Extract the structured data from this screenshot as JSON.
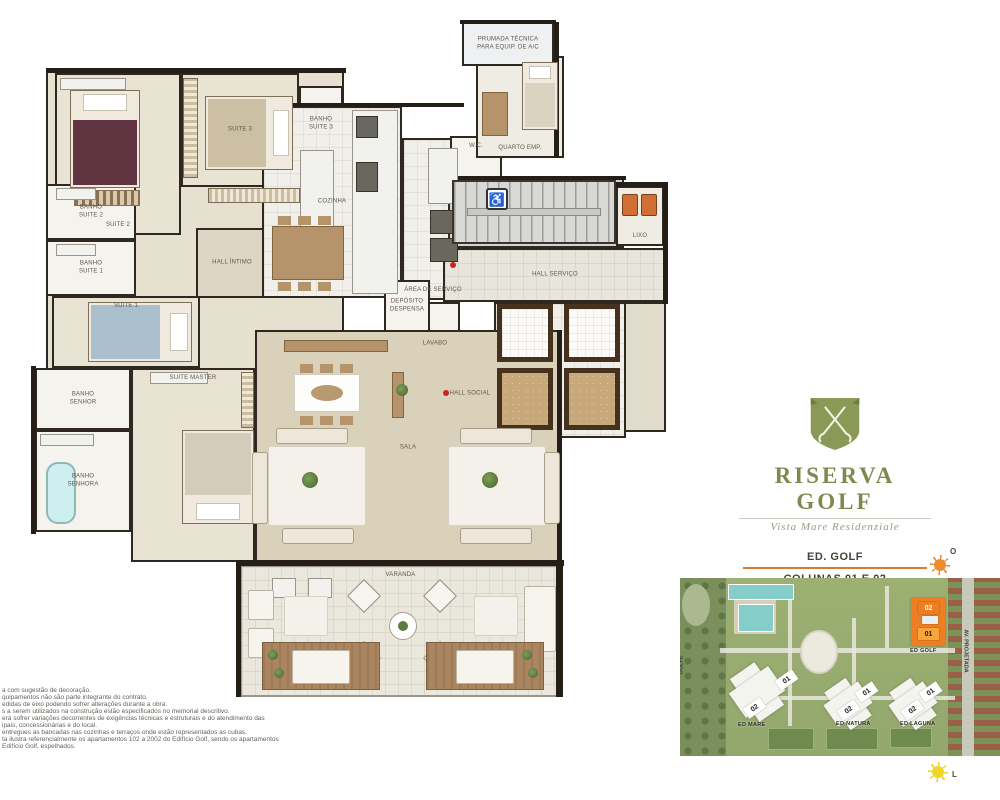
{
  "brand": {
    "name": "RISERVA GOLF",
    "tagline": "Vista Mare Residenziale"
  },
  "info": {
    "building": "ED. GOLF",
    "columns": "COLUNAS 01 E 02",
    "area": "Área Privativa - 381,06 m²"
  },
  "compass": {
    "west": "O",
    "east": "L"
  },
  "fine_print": {
    "lines": [
      "a com sugestão de decoração.",
      "quipamentos não são parte integrante do contrato.",
      "edidas de eixo podendo sofrer alterações durante a obra.",
      "s a serem utilizados na construção estão especificados no memorial descritivo.",
      "erá sofrer variações decorrentes de exigências técnicas e estruturais e do atendimento das",
      "ipais, concessionárias e do local.",
      "entregues as bancadas nas cozinhas e terraços onde estão representados as cubas.",
      "ta ilustra referencialmente os apartamentos 102 a 2002 do Edifício Golf, sendo os apartamentos",
      "Edifício Golf, espelhados."
    ]
  },
  "site_map": {
    "left_street": "GOLFE",
    "right_street": "AV. PROJETADA",
    "buildings": [
      {
        "id": "ed-mare",
        "name": "ED MARE",
        "lx": 58,
        "ly": 144,
        "bx": 62,
        "by": 88,
        "bw": 30,
        "bh": 52,
        "br": -35,
        "hl": false,
        "units": [
          {
            "t": "01",
            "x": 96,
            "y": 96,
            "r": -35,
            "s": "w"
          },
          {
            "t": "02",
            "x": 64,
            "y": 124,
            "r": -35,
            "s": "w"
          }
        ]
      },
      {
        "id": "ed-natura",
        "name": "ED NATURA",
        "lx": 156,
        "ly": 143,
        "bx": 155,
        "by": 103,
        "bw": 26,
        "bh": 46,
        "br": -35,
        "hl": false,
        "units": [
          {
            "t": "01",
            "x": 176,
            "y": 108,
            "r": -35,
            "s": "w"
          },
          {
            "t": "02",
            "x": 158,
            "y": 126,
            "r": -35,
            "s": "w"
          }
        ]
      },
      {
        "id": "ed-laguna",
        "name": "ED LAGUNA",
        "lx": 220,
        "ly": 143,
        "bx": 220,
        "by": 103,
        "bw": 26,
        "bh": 46,
        "br": -35,
        "hl": false,
        "units": [
          {
            "t": "01",
            "x": 240,
            "y": 108,
            "r": -35,
            "s": "w"
          },
          {
            "t": "02",
            "x": 222,
            "y": 126,
            "r": -35,
            "s": "w"
          }
        ]
      },
      {
        "id": "ed-golf",
        "name": "ED GOLF",
        "lx": 230,
        "ly": 70,
        "bx": 231,
        "by": 20,
        "bw": 34,
        "bh": 48,
        "br": 0,
        "hl": true,
        "units": [
          {
            "t": "02",
            "x": 238,
            "y": 24,
            "r": 0,
            "s": "o-dark"
          },
          {
            "t": "",
            "x": 242,
            "y": 38,
            "r": 0,
            "s": "mini"
          },
          {
            "t": "01",
            "x": 238,
            "y": 50,
            "r": 0,
            "s": "o-light"
          }
        ]
      }
    ]
  },
  "floor_plan": {
    "rooms": [
      {
        "id": "base-wing",
        "label": "",
        "x": 46,
        "y": 70,
        "w": 298,
        "h": 300,
        "bg": "#e6e0d0"
      },
      {
        "id": "suite-2",
        "label": "SUITE 2",
        "x": 55,
        "y": 73,
        "w": 126,
        "h": 162,
        "bg": "#e9e3d4",
        "lp": "bottom"
      },
      {
        "id": "suite-3",
        "label": "SUITE 3",
        "x": 181,
        "y": 73,
        "w": 118,
        "h": 114,
        "bg": "#e9e3d4"
      },
      {
        "id": "banho-suite-3",
        "label": "BANHO\nSUITE 3",
        "x": 299,
        "y": 86,
        "w": 44,
        "h": 76,
        "bg": "#f5f3ed"
      },
      {
        "id": "banho-suite-2",
        "label": "BANHO\nSUITE 2",
        "x": 46,
        "y": 184,
        "w": 90,
        "h": 56,
        "bg": "#f5f3ed"
      },
      {
        "id": "banho-suite-1",
        "label": "BANHO\nSUITE 1",
        "x": 46,
        "y": 240,
        "w": 90,
        "h": 56,
        "bg": "#f5f3ed"
      },
      {
        "id": "suite-1",
        "label": "SUITE 1",
        "x": 52,
        "y": 296,
        "w": 148,
        "h": 72,
        "bg": "#e9e3d4",
        "lp": "top"
      },
      {
        "id": "hall-intimo",
        "label": "HALL ÍNTIMO",
        "x": 196,
        "y": 228,
        "w": 72,
        "h": 70,
        "bg": "#ded6c4"
      },
      {
        "id": "banho-senhor",
        "label": "BANHO\nSENHOR",
        "x": 35,
        "y": 368,
        "w": 96,
        "h": 62,
        "bg": "#f5f3ed"
      },
      {
        "id": "banho-senhora",
        "label": "BANHO\nSENHORA",
        "x": 35,
        "y": 430,
        "w": 96,
        "h": 102,
        "bg": "#f5f3ed"
      },
      {
        "id": "suite-master",
        "label": "SUITE MASTER",
        "x": 131,
        "y": 368,
        "w": 124,
        "h": 194,
        "bg": "#e9e3d4",
        "lp": "top"
      },
      {
        "id": "cozinha",
        "label": "COZINHA",
        "x": 262,
        "y": 106,
        "w": 140,
        "h": 192,
        "bg": "#f1efe9",
        "grid": true
      },
      {
        "id": "area-servico",
        "label": "ÁREA DE SERVIÇO",
        "x": 402,
        "y": 138,
        "w": 62,
        "h": 162,
        "bg": "#f1efe9",
        "grid": true,
        "lp": "bottom"
      },
      {
        "id": "wc",
        "label": "W.C.",
        "x": 450,
        "y": 136,
        "w": 52,
        "h": 60,
        "bg": "#f5f3ed",
        "lp": "top"
      },
      {
        "id": "quarto-emp",
        "label": "QUARTO EMP.",
        "x": 476,
        "y": 56,
        "w": 88,
        "h": 102,
        "bg": "#efece4",
        "lp": "bottom"
      },
      {
        "id": "prumada",
        "label": "PRUMADA TÉCNICA\nPARA EQUIP. DE A/C",
        "x": 462,
        "y": 22,
        "w": 92,
        "h": 44,
        "bg": "#eef0f2"
      },
      {
        "id": "escada",
        "label": "",
        "x": 448,
        "y": 178,
        "w": 176,
        "h": 70,
        "bg": "#d4d4d2"
      },
      {
        "id": "lixo",
        "label": "LIXO",
        "x": 616,
        "y": 186,
        "w": 48,
        "h": 60,
        "bg": "#efece4",
        "lp": "bottom"
      },
      {
        "id": "hall-servico",
        "label": "HALL SERVIÇO",
        "x": 443,
        "y": 248,
        "w": 224,
        "h": 54,
        "bg": "#e8e5dd",
        "grid": true
      },
      {
        "id": "hall-vizinho",
        "label": "",
        "x": 620,
        "y": 302,
        "w": 46,
        "h": 130,
        "bg": "#e2dccc"
      },
      {
        "id": "elevadores",
        "label": "",
        "x": 494,
        "y": 302,
        "w": 132,
        "h": 136,
        "bg": "#f0eee8",
        "grid": true
      },
      {
        "id": "lavabo",
        "label": "LAVABO",
        "x": 410,
        "y": 302,
        "w": 50,
        "h": 84,
        "bg": "#f5f3ed"
      },
      {
        "id": "deposito",
        "label": "DEPÓSITO\nDESPENSA",
        "x": 384,
        "y": 280,
        "w": 46,
        "h": 52,
        "bg": "#f5f3ed"
      },
      {
        "id": "hall-social",
        "label": "HALL SOCIAL",
        "x": 436,
        "y": 356,
        "w": 68,
        "h": 76,
        "bg": "#e2dccc",
        "grid": true
      },
      {
        "id": "sala",
        "label": "SALA",
        "x": 255,
        "y": 330,
        "w": 306,
        "h": 235,
        "bg": "#d9d1b9"
      },
      {
        "id": "varanda",
        "label": "VARANDA",
        "x": 240,
        "y": 565,
        "w": 321,
        "h": 132,
        "bg": "#eae7dc",
        "bd": "light",
        "grid": true,
        "lp": "top"
      }
    ],
    "walls": [
      {
        "x": 46,
        "y": 68,
        "w": 300,
        "h": 5
      },
      {
        "x": 260,
        "y": 103,
        "w": 204,
        "h": 4
      },
      {
        "x": 460,
        "y": 20,
        "w": 96,
        "h": 4
      },
      {
        "x": 554,
        "y": 22,
        "w": 5,
        "h": 136
      },
      {
        "x": 446,
        "y": 176,
        "w": 180,
        "h": 4
      },
      {
        "x": 616,
        "y": 182,
        "w": 52,
        "h": 5
      },
      {
        "x": 663,
        "y": 184,
        "w": 5,
        "h": 120
      },
      {
        "x": 31,
        "y": 366,
        "w": 5,
        "h": 168
      },
      {
        "x": 238,
        "y": 560,
        "w": 326,
        "h": 6
      },
      {
        "x": 557,
        "y": 330,
        "w": 5,
        "h": 235
      },
      {
        "x": 236,
        "y": 560,
        "w": 5,
        "h": 137
      },
      {
        "x": 556,
        "y": 560,
        "w": 7,
        "h": 137
      }
    ],
    "furniture": [
      {
        "t": "counter",
        "x": 60,
        "y": 78,
        "w": 66,
        "h": 12
      },
      {
        "t": "bed",
        "v": "n",
        "x": 70,
        "y": 90,
        "w": 70,
        "h": 98,
        "bc": "#5f3340"
      },
      {
        "t": "rug",
        "x": 74,
        "y": 190,
        "w": 66,
        "h": 16
      },
      {
        "t": "ward-v",
        "x": 183,
        "y": 78,
        "w": 15,
        "h": 100
      },
      {
        "t": "bed",
        "v": "e",
        "x": 205,
        "y": 96,
        "w": 88,
        "h": 74,
        "bc": "#cdbfa4"
      },
      {
        "t": "ward-h",
        "x": 208,
        "y": 188,
        "w": 92,
        "h": 15
      },
      {
        "t": "counter",
        "x": 56,
        "y": 188,
        "w": 40,
        "h": 12
      },
      {
        "t": "counter",
        "x": 56,
        "y": 244,
        "w": 40,
        "h": 12
      },
      {
        "t": "bed",
        "v": "e",
        "x": 88,
        "y": 302,
        "w": 104,
        "h": 60,
        "bc": "#a9bfce"
      },
      {
        "t": "counter",
        "x": 150,
        "y": 372,
        "w": 58,
        "h": 12
      },
      {
        "t": "counter",
        "x": 40,
        "y": 434,
        "w": 54,
        "h": 12
      },
      {
        "t": "tub",
        "x": 46,
        "y": 462,
        "w": 30,
        "h": 62
      },
      {
        "t": "bed",
        "v": "s",
        "x": 182,
        "y": 430,
        "w": 72,
        "h": 94,
        "bc": "#d4ccba"
      },
      {
        "t": "ward-v",
        "x": 241,
        "y": 372,
        "w": 13,
        "h": 56
      },
      {
        "t": "counter",
        "x": 352,
        "y": 110,
        "w": 46,
        "h": 184
      },
      {
        "t": "appliance",
        "x": 356,
        "y": 116,
        "w": 22,
        "h": 22
      },
      {
        "t": "appliance",
        "x": 356,
        "y": 162,
        "w": 22,
        "h": 30
      },
      {
        "t": "counter",
        "x": 300,
        "y": 150,
        "w": 34,
        "h": 86
      },
      {
        "t": "chairs-h",
        "x": 278,
        "y": 216,
        "w": 60,
        "h": 9
      },
      {
        "t": "table-wood",
        "x": 272,
        "y": 226,
        "w": 72,
        "h": 54
      },
      {
        "t": "chairs-h",
        "x": 278,
        "y": 282,
        "w": 60,
        "h": 9
      },
      {
        "t": "counter",
        "x": 428,
        "y": 148,
        "w": 30,
        "h": 56
      },
      {
        "t": "appliance",
        "x": 430,
        "y": 210,
        "w": 28,
        "h": 24
      },
      {
        "t": "appliance",
        "x": 430,
        "y": 238,
        "w": 28,
        "h": 24
      },
      {
        "t": "bed",
        "v": "n",
        "x": 522,
        "y": 62,
        "w": 36,
        "h": 68,
        "bc": "#dad3c2"
      },
      {
        "t": "table-wood",
        "x": 482,
        "y": 92,
        "w": 26,
        "h": 44
      },
      {
        "t": "stairs",
        "x": 452,
        "y": 180,
        "w": 164,
        "h": 64
      },
      {
        "t": "access",
        "x": 486,
        "y": 188,
        "w": 22,
        "h": 22,
        "txt": "♿"
      },
      {
        "t": "bin",
        "x": 622,
        "y": 194,
        "w": 16,
        "h": 22
      },
      {
        "t": "bin",
        "x": 641,
        "y": 194,
        "w": 16,
        "h": 22
      },
      {
        "t": "dot",
        "x": 450,
        "y": 262,
        "w": 6,
        "h": 6
      },
      {
        "t": "dot",
        "x": 443,
        "y": 390,
        "w": 6,
        "h": 6
      },
      {
        "t": "elev-l",
        "x": 497,
        "y": 304,
        "w": 56,
        "h": 58
      },
      {
        "t": "elev-l",
        "x": 564,
        "y": 304,
        "w": 56,
        "h": 58
      },
      {
        "t": "elev-d",
        "x": 497,
        "y": 368,
        "w": 56,
        "h": 62
      },
      {
        "t": "elev-d",
        "x": 564,
        "y": 368,
        "w": 56,
        "h": 62
      },
      {
        "t": "sideboard",
        "x": 284,
        "y": 340,
        "w": 104,
        "h": 12
      },
      {
        "t": "chairs-h",
        "x": 300,
        "y": 364,
        "w": 58,
        "h": 9
      },
      {
        "t": "table-white",
        "x": 294,
        "y": 374,
        "w": 66,
        "h": 38
      },
      {
        "t": "chairs-h",
        "x": 300,
        "y": 416,
        "w": 58,
        "h": 9
      },
      {
        "t": "sideboard",
        "x": 392,
        "y": 372,
        "w": 12,
        "h": 46
      },
      {
        "t": "plant",
        "x": 396,
        "y": 384,
        "w": 12,
        "h": 12
      },
      {
        "t": "rug-white",
        "x": 268,
        "y": 446,
        "w": 98,
        "h": 80
      },
      {
        "t": "sofa",
        "x": 252,
        "y": 452,
        "w": 16,
        "h": 72
      },
      {
        "t": "sofa",
        "x": 276,
        "y": 428,
        "w": 72,
        "h": 16
      },
      {
        "t": "sofa",
        "x": 282,
        "y": 528,
        "w": 72,
        "h": 16
      },
      {
        "t": "plant",
        "x": 302,
        "y": 472,
        "w": 16,
        "h": 16
      },
      {
        "t": "rug-white",
        "x": 448,
        "y": 446,
        "w": 98,
        "h": 80
      },
      {
        "t": "sofa",
        "x": 460,
        "y": 428,
        "w": 72,
        "h": 16
      },
      {
        "t": "sofa",
        "x": 544,
        "y": 452,
        "w": 16,
        "h": 72
      },
      {
        "t": "sofa",
        "x": 460,
        "y": 528,
        "w": 72,
        "h": 16
      },
      {
        "t": "plant",
        "x": 482,
        "y": 472,
        "w": 16,
        "h": 16
      },
      {
        "t": "counter",
        "x": 272,
        "y": 578,
        "w": 24,
        "h": 20
      },
      {
        "t": "counter",
        "x": 308,
        "y": 578,
        "w": 24,
        "h": 20
      },
      {
        "t": "daybed",
        "x": 248,
        "y": 590,
        "w": 26,
        "h": 30
      },
      {
        "t": "daybed",
        "x": 248,
        "y": 628,
        "w": 26,
        "h": 30
      },
      {
        "t": "rug-white",
        "x": 284,
        "y": 596,
        "w": 44,
        "h": 40
      },
      {
        "t": "rug-white",
        "x": 474,
        "y": 596,
        "w": 44,
        "h": 40
      },
      {
        "t": "daybed",
        "x": 524,
        "y": 586,
        "w": 32,
        "h": 66
      },
      {
        "t": "circle",
        "x": 389,
        "y": 612,
        "w": 28,
        "h": 28
      },
      {
        "t": "diamond",
        "x": 352,
        "y": 584,
        "w": 24,
        "h": 24
      },
      {
        "t": "diamond",
        "x": 428,
        "y": 584,
        "w": 24,
        "h": 24
      },
      {
        "t": "diamond",
        "x": 352,
        "y": 646,
        "w": 24,
        "h": 24
      },
      {
        "t": "diamond",
        "x": 428,
        "y": 646,
        "w": 24,
        "h": 24
      },
      {
        "t": "deck",
        "x": 262,
        "y": 642,
        "w": 118,
        "h": 48
      },
      {
        "t": "daybed",
        "x": 292,
        "y": 650,
        "w": 58,
        "h": 34
      },
      {
        "t": "plant",
        "x": 268,
        "y": 650,
        "w": 10,
        "h": 10
      },
      {
        "t": "plant",
        "x": 274,
        "y": 668,
        "w": 10,
        "h": 10
      },
      {
        "t": "deck",
        "x": 426,
        "y": 642,
        "w": 118,
        "h": 48
      },
      {
        "t": "daybed",
        "x": 456,
        "y": 650,
        "w": 58,
        "h": 34
      },
      {
        "t": "plant",
        "x": 522,
        "y": 650,
        "w": 10,
        "h": 10
      },
      {
        "t": "plant",
        "x": 528,
        "y": 668,
        "w": 10,
        "h": 10
      }
    ]
  }
}
